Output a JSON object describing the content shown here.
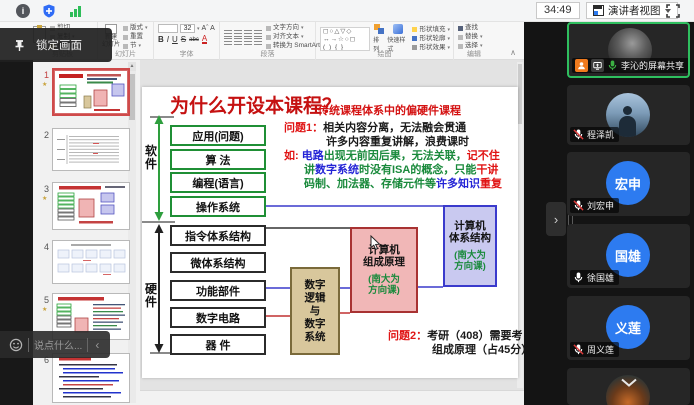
{
  "topbar": {
    "timer": "34:49",
    "view_button": "演讲者视图"
  },
  "overlays": {
    "lock_tooltip": "锁定画面",
    "chat_placeholder": "说点什么...",
    "sidebar_collapse": "›",
    "chat_collapse": "‹"
  },
  "ppt": {
    "ribbon": {
      "groups": [
        {
          "label": "剪贴板",
          "items": [
            "剪切",
            "复制",
            "格式刷"
          ]
        },
        {
          "label": "幻灯片",
          "new_slide": "新建\n幻灯片",
          "items": [
            "版式",
            "重置",
            "节"
          ]
        },
        {
          "label": "字体",
          "font_size": "32",
          "items": [
            "B",
            "I",
            "U",
            "S",
            "abc"
          ]
        },
        {
          "label": "段落",
          "items": [
            "文字方向",
            "对齐文本",
            "转换为 SmartArt"
          ]
        },
        {
          "label": "绘图",
          "items": [
            "排列",
            "快速样式",
            "形状填充",
            "形状轮廓",
            "形状效果"
          ]
        },
        {
          "label": "编辑",
          "items": [
            "查找",
            "替换",
            "选择"
          ]
        }
      ],
      "collapse_icon": "∧"
    },
    "thumbnails": [
      {
        "number": "1",
        "selected": true
      },
      {
        "number": "2"
      },
      {
        "number": "3"
      },
      {
        "number": "4"
      },
      {
        "number": "5"
      },
      {
        "number": "6"
      }
    ],
    "slide": {
      "title": "为什么开设本课程？",
      "subtitle": "传统课程体系中的偏硬件课程",
      "software_label": "软\n件",
      "hardware_label": "硬\n件",
      "software_layers": [
        "应用(问题)",
        "算 法",
        "编程(语言)",
        "操作系统"
      ],
      "hardware_layers": [
        "指令体系结构",
        "微体系结构",
        "功能部件",
        "数字电路",
        "器 件"
      ],
      "digital_box": "数字\n逻辑\n与\n数字\n系统",
      "zucheng_box": {
        "title": "计算机\n组成原理",
        "note": "(南大为\n方向课)"
      },
      "tixi_box": {
        "title": "计算机\n体系结构",
        "note": "(南大为\n方向课)"
      },
      "problem1": {
        "lines": [
          [
            {
              "t": "问题1：",
              "c": "#e01414"
            },
            {
              "t": "相关内容分离，无法融会贯通",
              "c": "#1a1a1a"
            }
          ],
          [
            {
              "t": "许多内容重复讲解，浪费课时",
              "c": "#1a1a1a"
            }
          ],
          [
            {
              "t": "如: ",
              "c": "#e01414"
            },
            {
              "t": "电路",
              "c": "#2323d6"
            },
            {
              "t": "出现无前因后果，无法关联，",
              "c": "#1a8a3c"
            },
            {
              "t": "记不住",
              "c": "#e01414"
            }
          ],
          [
            {
              "t": "讲",
              "c": "#1a8a3c"
            },
            {
              "t": "数字系统",
              "c": "#2323d6"
            },
            {
              "t": "时没有ISA的概念，只能",
              "c": "#1a8a3c"
            },
            {
              "t": "干讲",
              "c": "#e01414"
            }
          ],
          [
            {
              "t": "码制、加法器、存储元件等",
              "c": "#1a8a3c"
            },
            {
              "t": "许多知识",
              "c": "#2323d6"
            },
            {
              "t": "重复",
              "c": "#e01414"
            }
          ]
        ]
      },
      "problem2": {
        "lines": [
          [
            {
              "t": "问题2：",
              "c": "#e01414"
            },
            {
              "t": "考研（408）需要考",
              "c": "#1a1a1a"
            }
          ],
          [
            {
              "t": "组成原理（占45分）",
              "c": "#1a1a1a"
            }
          ]
        ]
      }
    }
  },
  "participants": [
    {
      "name": "李沁的屏幕共享",
      "mic": "on",
      "role": "host",
      "sharing": true,
      "active_speaker": true
    },
    {
      "name": "程泽凯",
      "mic": "muted"
    },
    {
      "name": "刘宏申",
      "avatar_text": "宏申",
      "mic": "muted"
    },
    {
      "name": "徐国雄",
      "avatar_text": "国雄",
      "mic": "on"
    },
    {
      "name": "周义莲",
      "avatar_text": "义莲",
      "mic": "muted"
    },
    {
      "name": "",
      "mic": "unknown"
    }
  ],
  "colors": {
    "active_speaker_green": "#2fbf5f",
    "avatar_blue": "#2d7bf0",
    "host_badge_orange": "#f07a1d",
    "mic_on_green": "#3cb043",
    "mute_slash_red": "#e03b3b",
    "slide_red": "#e01414",
    "slide_green": "#1a8a3c",
    "slide_blue": "#2323d6",
    "box_green_border": "#1f8f35",
    "box_pink_fill": "#f1b7b7",
    "box_purple_fill": "#c9c9f0",
    "box_tan_fill": "#d8c79c"
  }
}
